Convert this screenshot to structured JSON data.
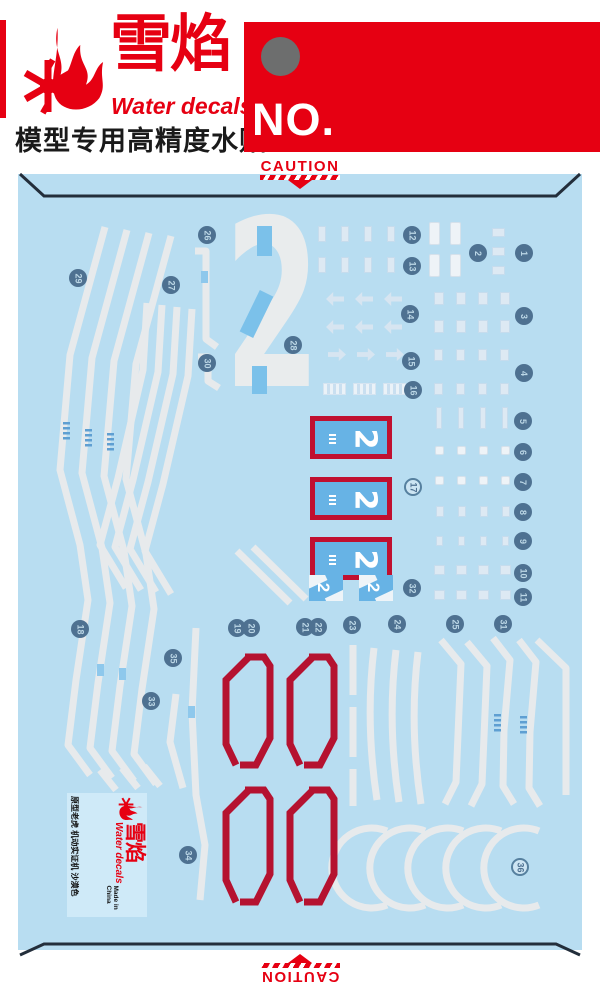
{
  "header": {
    "brand_cn": "雪焰",
    "brand_en": "Water decals",
    "tagline_cn": "模型专用高精度水贴",
    "no_label": "NO.",
    "accent_red": "#e60012",
    "punch_dot_gray": "#6d6e6e"
  },
  "sheet": {
    "caution_label": "CAUTION",
    "bg_blue": "#b8ddf1",
    "panel_blue": "#67b3e5",
    "frame_red": "#c01030",
    "stencil_red": "#b51230",
    "stripe_white": "#e7eaec",
    "badge_blue": "#4e7191",
    "big_numeral": "2",
    "panel_numeral": "2",
    "badges": [
      {
        "n": 1,
        "x": 524,
        "y": 253
      },
      {
        "n": 2,
        "x": 478,
        "y": 253
      },
      {
        "n": 3,
        "x": 524,
        "y": 316
      },
      {
        "n": 4,
        "x": 524,
        "y": 373
      },
      {
        "n": 5,
        "x": 523,
        "y": 421
      },
      {
        "n": 6,
        "x": 523,
        "y": 452
      },
      {
        "n": 7,
        "x": 523,
        "y": 482
      },
      {
        "n": 8,
        "x": 523,
        "y": 512
      },
      {
        "n": 9,
        "x": 523,
        "y": 541
      },
      {
        "n": 10,
        "x": 523,
        "y": 573
      },
      {
        "n": 11,
        "x": 523,
        "y": 597
      },
      {
        "n": 12,
        "x": 412,
        "y": 235
      },
      {
        "n": 13,
        "x": 412,
        "y": 266
      },
      {
        "n": 14,
        "x": 410,
        "y": 314
      },
      {
        "n": 15,
        "x": 411,
        "y": 361
      },
      {
        "n": 16,
        "x": 413,
        "y": 390
      },
      {
        "n": 17,
        "x": 413,
        "y": 487,
        "light": true
      },
      {
        "n": 18,
        "x": 80,
        "y": 629
      },
      {
        "n": 19,
        "x": 237,
        "y": 628
      },
      {
        "n": 20,
        "x": 251,
        "y": 628
      },
      {
        "n": 21,
        "x": 305,
        "y": 627
      },
      {
        "n": 22,
        "x": 318,
        "y": 627
      },
      {
        "n": 23,
        "x": 352,
        "y": 625
      },
      {
        "n": 24,
        "x": 397,
        "y": 624
      },
      {
        "n": 25,
        "x": 455,
        "y": 624
      },
      {
        "n": 26,
        "x": 207,
        "y": 235
      },
      {
        "n": 27,
        "x": 171,
        "y": 285
      },
      {
        "n": 28,
        "x": 293,
        "y": 345
      },
      {
        "n": 29,
        "x": 78,
        "y": 278
      },
      {
        "n": 30,
        "x": 207,
        "y": 363
      },
      {
        "n": 31,
        "x": 503,
        "y": 624
      },
      {
        "n": 32,
        "x": 412,
        "y": 588
      },
      {
        "n": 33,
        "x": 151,
        "y": 701
      },
      {
        "n": 34,
        "x": 188,
        "y": 855
      },
      {
        "n": 35,
        "x": 173,
        "y": 658
      },
      {
        "n": 36,
        "x": 520,
        "y": 867,
        "light": true
      }
    ],
    "glyph_groups": [
      {
        "x": 318,
        "y": 226,
        "n": 4,
        "dx": 23,
        "w": 8,
        "h": 16,
        "cls": "pale"
      },
      {
        "x": 318,
        "y": 257,
        "n": 4,
        "dx": 23,
        "w": 8,
        "h": 16,
        "cls": "pale"
      },
      {
        "x": 429,
        "y": 222,
        "n": 2,
        "dx": 21,
        "w": 11,
        "h": 23,
        "cls": "white"
      },
      {
        "x": 429,
        "y": 254,
        "n": 2,
        "dx": 21,
        "w": 11,
        "h": 23,
        "cls": "white"
      },
      {
        "x": 492,
        "y": 228,
        "n": 1,
        "dx": 0,
        "w": 13,
        "h": 9,
        "cls": "pale"
      },
      {
        "x": 492,
        "y": 247,
        "n": 1,
        "dx": 0,
        "w": 13,
        "h": 9,
        "cls": "pale"
      },
      {
        "x": 492,
        "y": 266,
        "n": 1,
        "dx": 0,
        "w": 13,
        "h": 9,
        "cls": "pale"
      },
      {
        "x": 326,
        "y": 292,
        "n": 3,
        "dx": 29,
        "w": 18,
        "h": 14,
        "cls": "arrow-l"
      },
      {
        "x": 326,
        "y": 320,
        "n": 3,
        "dx": 29,
        "w": 18,
        "h": 14,
        "cls": "arrow-l"
      },
      {
        "x": 328,
        "y": 348,
        "n": 3,
        "dx": 29,
        "w": 18,
        "h": 13,
        "cls": "arrow-r"
      },
      {
        "x": 323,
        "y": 383,
        "n": 3,
        "dx": 30,
        "w": 23,
        "h": 12,
        "cls": "striped"
      },
      {
        "x": 434,
        "y": 292,
        "n": 4,
        "dx": 22,
        "w": 10,
        "h": 13,
        "cls": "pale"
      },
      {
        "x": 434,
        "y": 320,
        "n": 4,
        "dx": 22,
        "w": 10,
        "h": 13,
        "cls": "pale"
      },
      {
        "x": 434,
        "y": 349,
        "n": 4,
        "dx": 22,
        "w": 9,
        "h": 12,
        "cls": "pale"
      },
      {
        "x": 434,
        "y": 383,
        "n": 4,
        "dx": 22,
        "w": 9,
        "h": 12,
        "cls": "pale"
      },
      {
        "x": 436,
        "y": 407,
        "n": 4,
        "dx": 22,
        "w": 6,
        "h": 22,
        "cls": "tall"
      },
      {
        "x": 435,
        "y": 446,
        "n": 4,
        "dx": 22,
        "w": 9,
        "h": 9,
        "cls": "white"
      },
      {
        "x": 435,
        "y": 476,
        "n": 4,
        "dx": 22,
        "w": 9,
        "h": 9,
        "cls": "white"
      },
      {
        "x": 436,
        "y": 506,
        "n": 4,
        "dx": 22,
        "w": 8,
        "h": 11,
        "cls": "pale"
      },
      {
        "x": 436,
        "y": 536,
        "n": 4,
        "dx": 22,
        "w": 7,
        "h": 10,
        "cls": "pale"
      },
      {
        "x": 434,
        "y": 565,
        "n": 4,
        "dx": 22,
        "w": 11,
        "h": 10,
        "cls": "pale"
      },
      {
        "x": 434,
        "y": 590,
        "n": 4,
        "dx": 22,
        "w": 11,
        "h": 10,
        "cls": "pale"
      }
    ],
    "footer_logo": {
      "brand_cn": "雪焰",
      "brand_en": "Water decals",
      "desc_cn": "原型老虎 机动实证机 沙漠色",
      "made_in": "Made in China"
    }
  }
}
